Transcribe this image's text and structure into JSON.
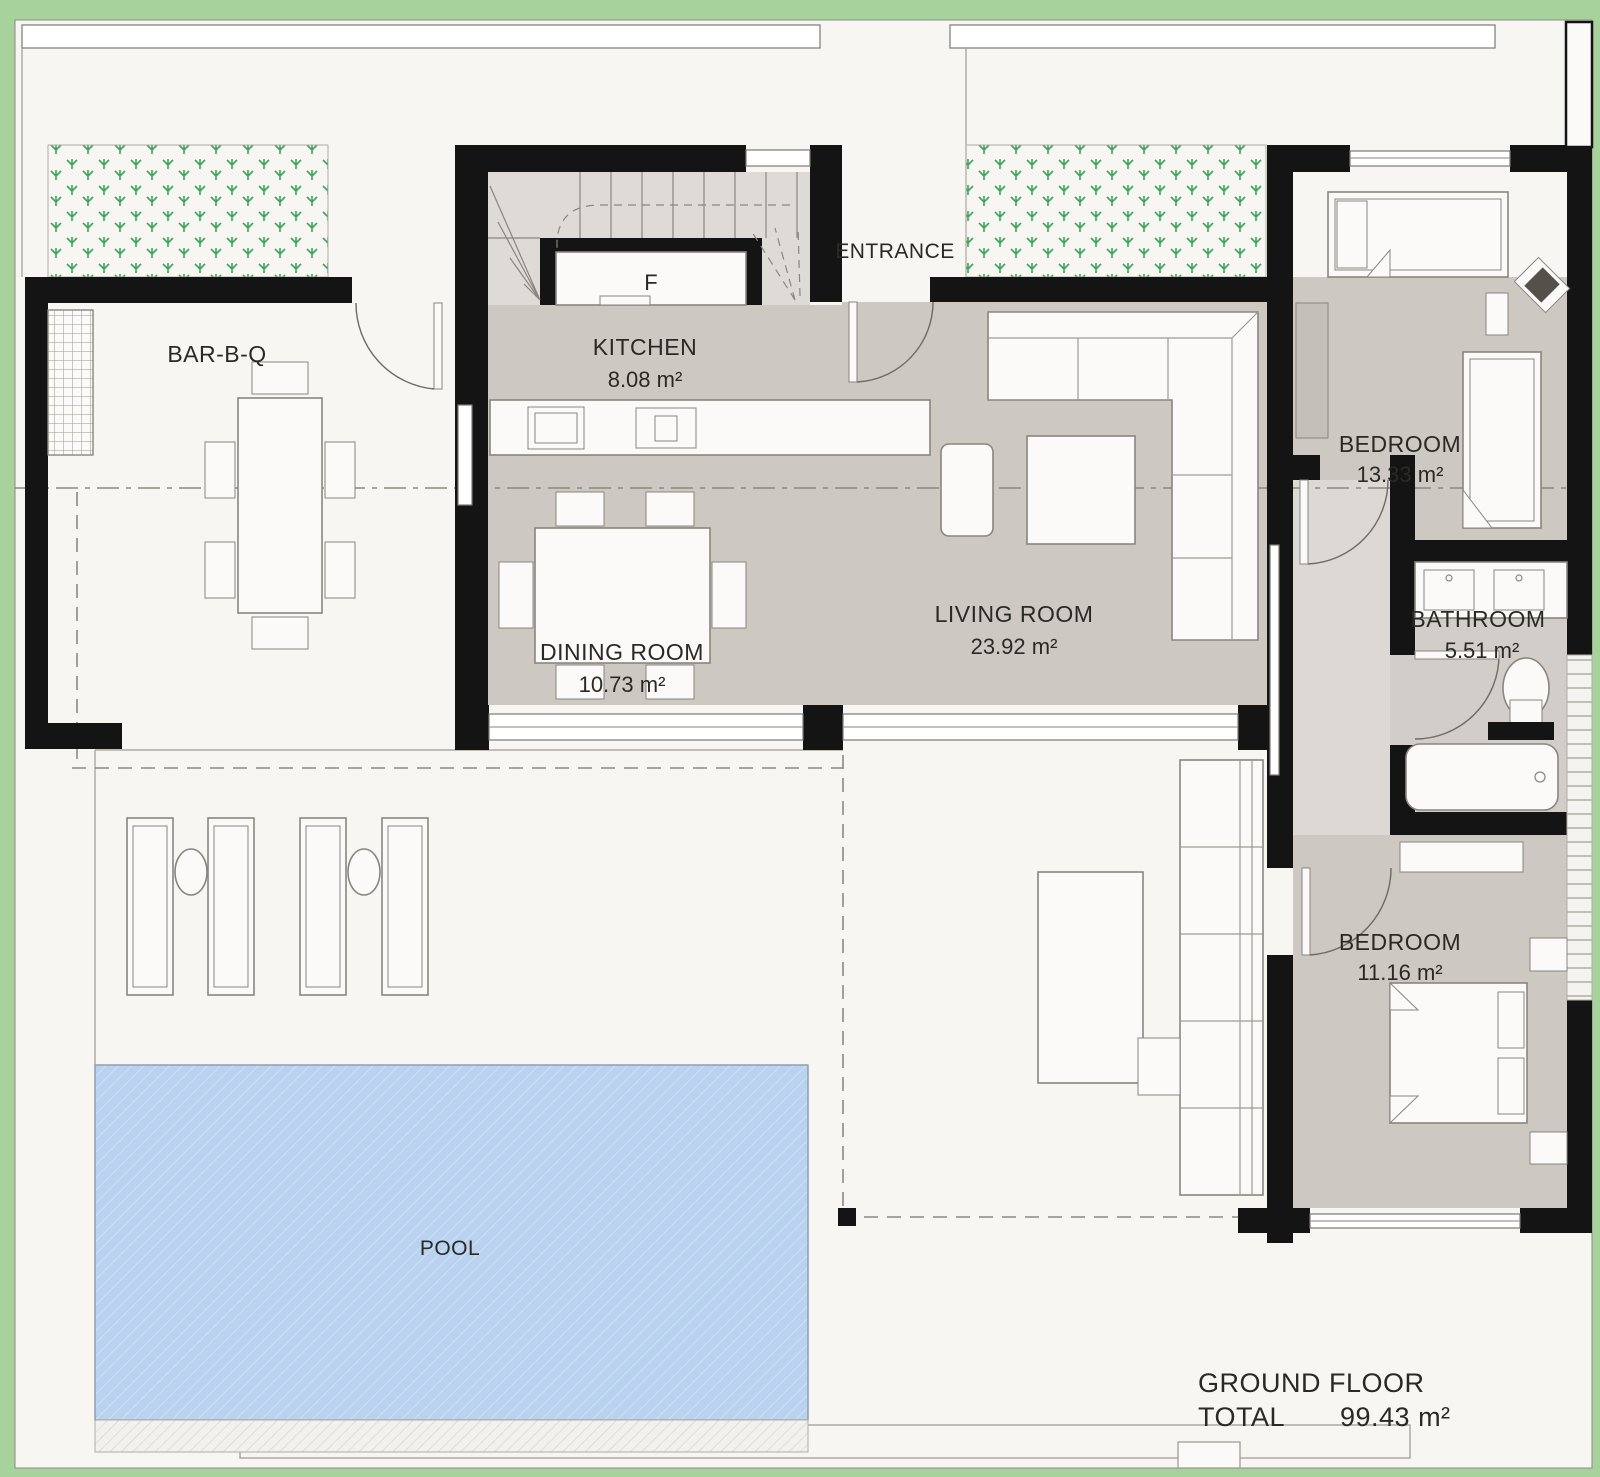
{
  "plan_title": "Ground floor plan",
  "colors": {
    "background_green": "#a8d29c",
    "sheet_white": "#f7f6f3",
    "wall_black": "#141414",
    "room_floor_gray": "#cdc8c2",
    "hall_floor_gray": "#dcd8d4",
    "stair_gray": "#dedbd7",
    "pool_blue": "#b9d2ef",
    "grass_plant_green": "#3aa65a",
    "furniture_stroke": "#8a857f"
  },
  "rooms": [
    {
      "id": "barbq",
      "name": "BAR-B-Q",
      "area": ""
    },
    {
      "id": "kitchen",
      "name": "KITCHEN",
      "area": "8.08 m²"
    },
    {
      "id": "dining",
      "name": "DINING ROOM",
      "area": "10.73 m²"
    },
    {
      "id": "living",
      "name": "LIVING ROOM",
      "area": "23.92 m²"
    },
    {
      "id": "bedroom1",
      "name": "BEDROOM",
      "area": "13.33 m²"
    },
    {
      "id": "bathroom",
      "name": "BATHROOM",
      "area": "5.51 m²"
    },
    {
      "id": "bedroom2",
      "name": "BEDROOM",
      "area": "11.16 m²"
    },
    {
      "id": "pool",
      "name": "POOL",
      "area": ""
    },
    {
      "id": "entrance",
      "name": "ENTRANCE",
      "area": ""
    }
  ],
  "labels": {
    "fridge": "F"
  },
  "total": {
    "line1": "GROUND FLOOR",
    "total_label": "TOTAL",
    "total_value": "99.43 m²"
  }
}
